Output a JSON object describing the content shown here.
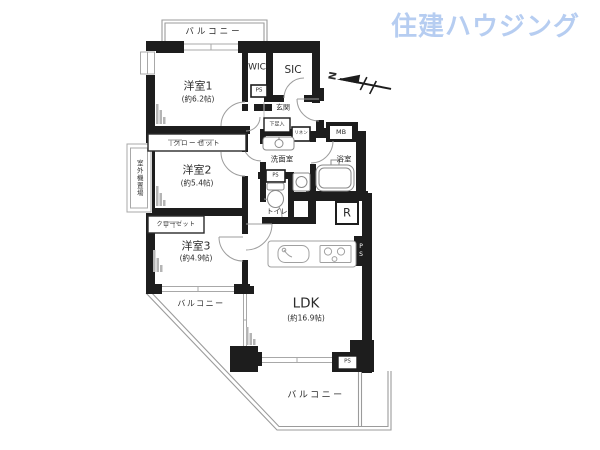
{
  "logo": {
    "text": "住建ハウジング",
    "color": "#b6cdf1"
  },
  "compass": {
    "n": "N"
  },
  "rooms": {
    "y1": {
      "name": "洋室1",
      "size": "(約6.2帖)"
    },
    "y2": {
      "name": "洋室2",
      "size": "(約5.4帖)"
    },
    "y3": {
      "name": "洋室3",
      "size": "(約4.9帖)"
    },
    "ldk": {
      "name": "LDK",
      "size": "(約16.9帖)"
    },
    "wic": "WIC",
    "sic": "SIC",
    "genkan": "玄関",
    "senmen": "洗面室",
    "bath": "浴室",
    "toilet": "トイレ"
  },
  "storage": {
    "closet1": "クローゼット",
    "closet2": "クローゼット",
    "shoe": "下足入",
    "linen": "リネン"
  },
  "service": {
    "mb": "MB",
    "r": "R",
    "ps1": "PS",
    "ps2": "PS",
    "ps3": "PS",
    "ps4": "PS",
    "outdoor_unit": "室外機置場"
  },
  "balcony": {
    "top": "バルコニー",
    "left": "バルコニー",
    "bottom": "バルコニー"
  }
}
